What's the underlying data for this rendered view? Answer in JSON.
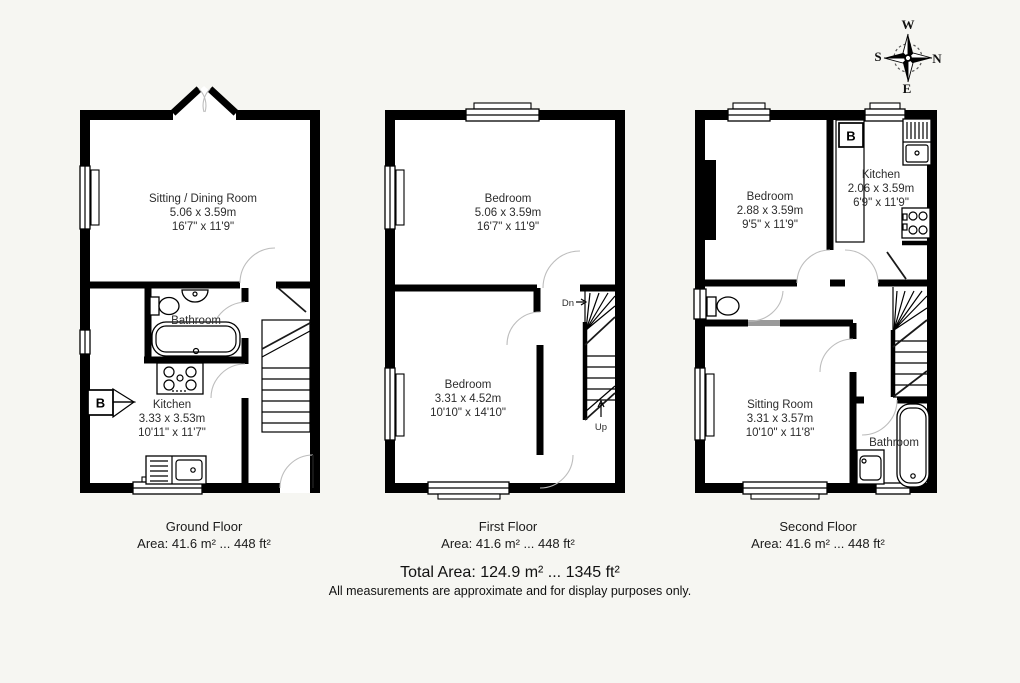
{
  "compass": {
    "north": "N",
    "east": "E",
    "south": "S",
    "west": "W"
  },
  "floors": [
    {
      "caption": "Ground Floor",
      "area": "Area: 41.6 m² ... 448 ft²",
      "boiler_label": "B",
      "rooms": [
        {
          "name": "Sitting / Dining Room",
          "metric": "5.06 x 3.59m",
          "imperial": "16'7\" x 11'9\""
        },
        {
          "name": "Bathroom",
          "metric": "",
          "imperial": ""
        },
        {
          "name": "Kitchen",
          "metric": "3.33 x 3.53m",
          "imperial": "10'11\" x 11'7\""
        }
      ]
    },
    {
      "caption": "First Floor",
      "area": "Area: 41.6 m² ... 448 ft²",
      "stairs": {
        "down": "Dn",
        "up": "Up"
      },
      "rooms": [
        {
          "name": "Bedroom",
          "metric": "5.06 x 3.59m",
          "imperial": "16'7\" x 11'9\""
        },
        {
          "name": "Bedroom",
          "metric": "3.31 x 4.52m",
          "imperial": "10'10\" x 14'10\""
        }
      ]
    },
    {
      "caption": "Second Floor",
      "area": "Area: 41.6 m² ... 448 ft²",
      "boiler_label": "B",
      "rooms": [
        {
          "name": "Bedroom",
          "metric": "2.88 x 3.59m",
          "imperial": "9'5\" x 11'9\""
        },
        {
          "name": "Kitchen",
          "metric": "2.06 x 3.59m",
          "imperial": "6'9\" x 11'9\""
        },
        {
          "name": "Sitting Room",
          "metric": "3.31 x 3.57m",
          "imperial": "10'10\" x 11'8\""
        },
        {
          "name": "Bathroom",
          "metric": "",
          "imperial": ""
        }
      ]
    }
  ],
  "footer": {
    "total": "Total Area: 124.9 m² ... 1345 ft²",
    "disclaimer": "All measurements are approximate and for display purposes only."
  }
}
